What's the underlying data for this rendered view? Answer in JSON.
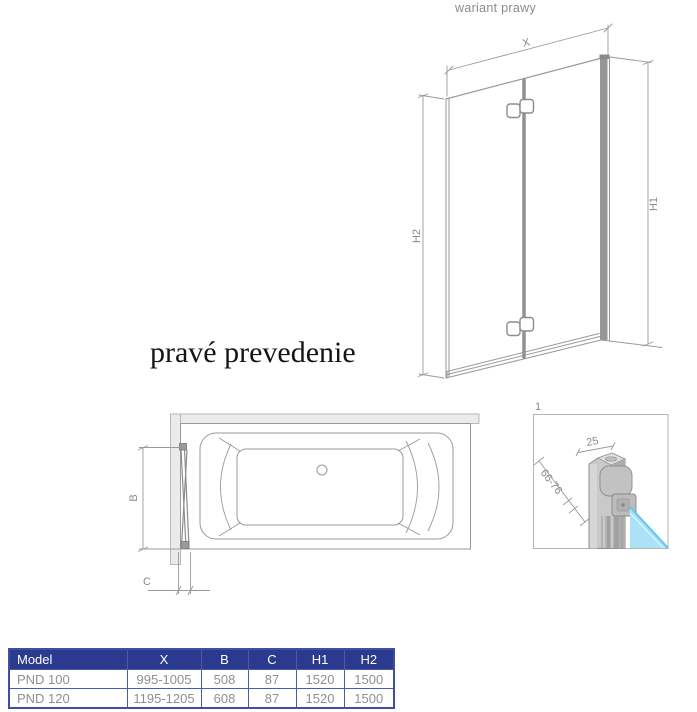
{
  "colors": {
    "line_gray": "#9a9a9a",
    "label_gray": "#8a8a8a",
    "table_header_bg": "#2b3a8f",
    "table_border": "#4a5bab",
    "table_text": "#8f8f8f",
    "glass_blue": "#ace2f7"
  },
  "front_view": {
    "variant_label": "wariant prawy",
    "dim_width": "X",
    "dim_height_outer": "H1",
    "dim_height_inner": "H2"
  },
  "caption": "pravé prevedenie",
  "top_view": {
    "dim_b": "B",
    "dim_c": "C"
  },
  "detail_view": {
    "number": "1",
    "dim_profile_width": "25",
    "dim_adjust_range": "66-76"
  },
  "table": {
    "headers": [
      "Model",
      "X",
      "B",
      "C",
      "H1",
      "H2"
    ],
    "rows": [
      [
        "PND 100",
        "995-1005",
        "508",
        "87",
        "1520",
        "1500"
      ],
      [
        "PND 120",
        "1195-1205",
        "608",
        "87",
        "1520",
        "1500"
      ]
    ]
  }
}
